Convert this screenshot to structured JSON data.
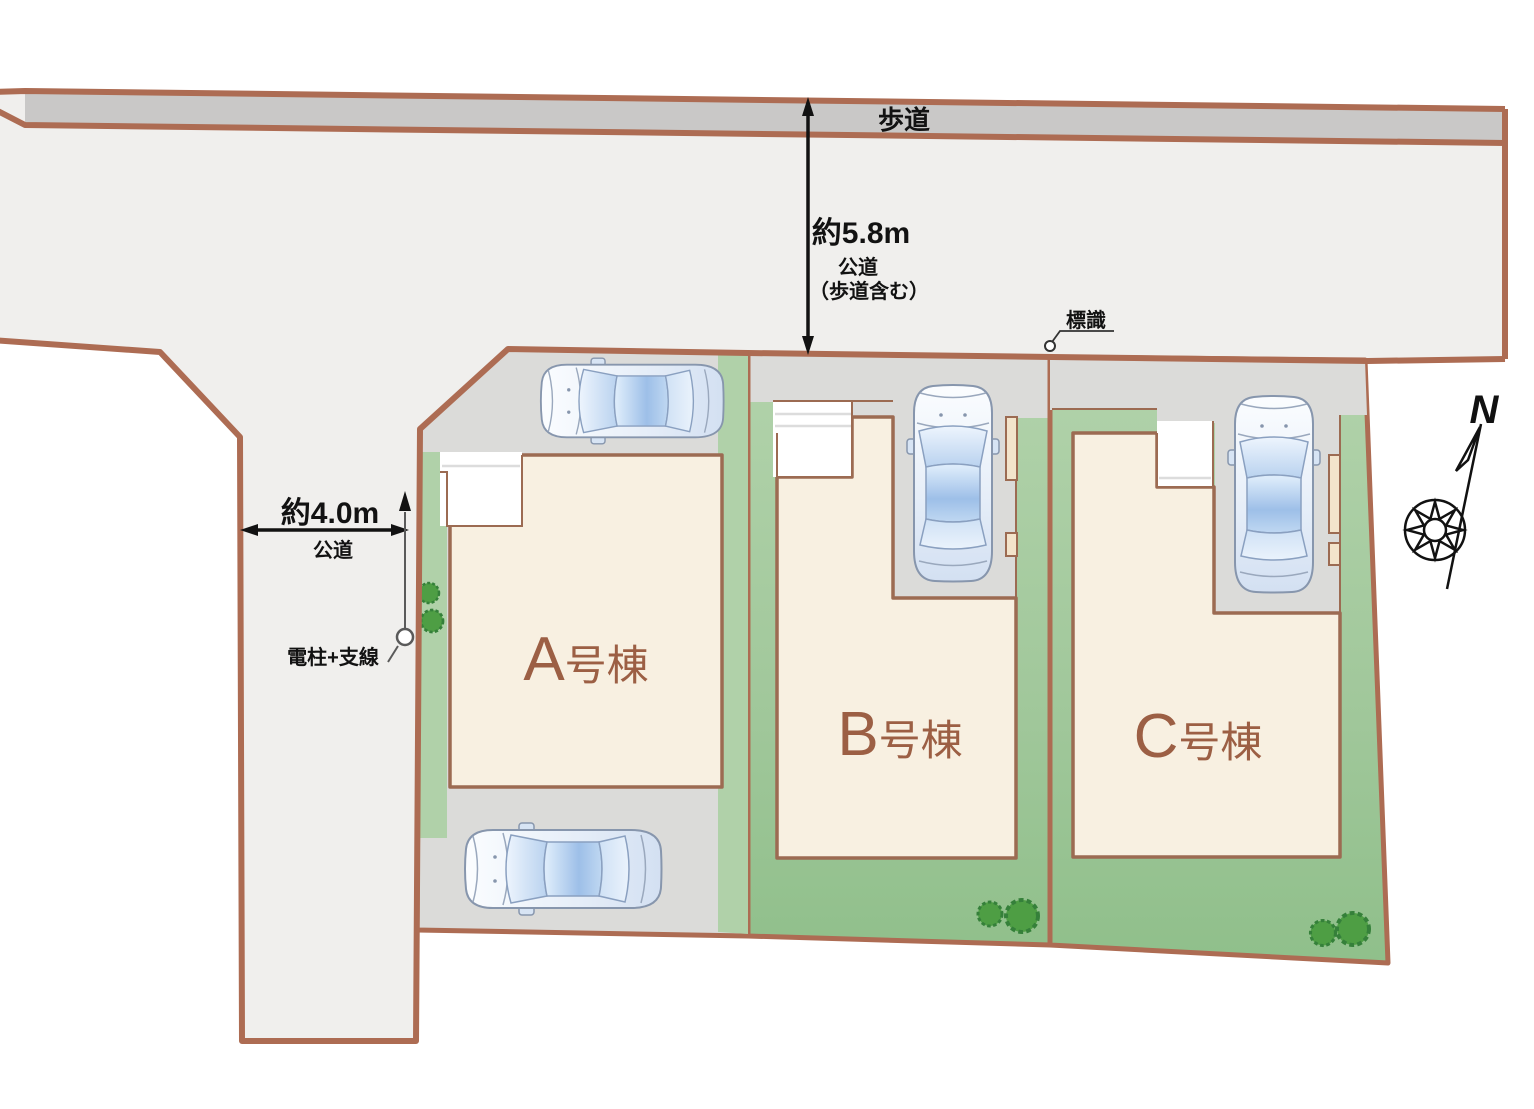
{
  "plan": {
    "sidewalk_label": "歩道",
    "front_road": {
      "width": "約5.8m",
      "type": "公道",
      "note": "（歩道含む）"
    },
    "side_road": {
      "width": "約4.0m",
      "type": "公道"
    },
    "sign_label": "標識",
    "utility_pole_label": "電柱+支線",
    "compass_north_label": "N",
    "houses": [
      {
        "id": "A",
        "letter": "A",
        "suffix": "号棟",
        "label": "A号棟"
      },
      {
        "id": "B",
        "letter": "B",
        "suffix": "号棟",
        "label": "B号棟"
      },
      {
        "id": "C",
        "letter": "C",
        "suffix": "号棟",
        "label": "C号棟"
      }
    ],
    "colors": {
      "boundary": "#ad6c53",
      "boundary_inner": "#9c6b52",
      "road": "#f0efed",
      "sidewalk": "#c9c8c7",
      "driveway": "#dbdbd9",
      "lawn": "#b0d1a9",
      "lawn_deep": "#8fbf8a",
      "house": "#f8f0e1",
      "house_label": "#9c5f44",
      "porch": "#ffffff",
      "fence": "#f3e4cb",
      "tree": "#4e9e44",
      "tree_outline": "#35803a",
      "annotation": "#121212"
    }
  }
}
